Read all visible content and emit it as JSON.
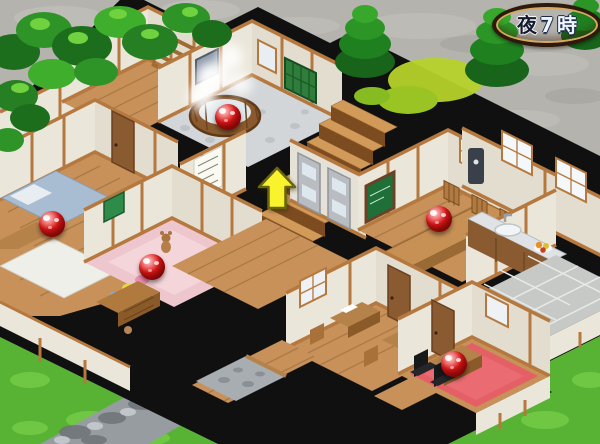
{
  "hud": {
    "time_badge": {
      "text": "夜7時",
      "parts": [
        "夜",
        "7",
        "時"
      ],
      "wood_color": "#a06a2e",
      "border_color": "#2e1a0c"
    }
  },
  "indicators": {
    "arrow": {
      "x": 277,
      "y": 190,
      "direction": "up",
      "color": "#f8f32c"
    },
    "ball_color": "#e01818",
    "balls": [
      {
        "id": "ball-bathtub",
        "x": 228,
        "y": 117
      },
      {
        "id": "ball-bedroom-futon",
        "x": 52,
        "y": 224
      },
      {
        "id": "ball-kids-room",
        "x": 152,
        "y": 267
      },
      {
        "id": "ball-dining-table",
        "x": 439,
        "y": 219
      },
      {
        "id": "ball-desk-room",
        "x": 454,
        "y": 364
      }
    ]
  },
  "palette": {
    "wall": "#ebe6da",
    "wood_frame": "#b5793f",
    "wood_floor": "#c8915a",
    "cut_wall_black": "#101010",
    "grass": "#5cb836",
    "stone_ground": "#b5b3ae",
    "tatami_futon": "#a8bdd2",
    "kids_carpet": "#eec6cd",
    "office_carpet": "#e45f66"
  }
}
